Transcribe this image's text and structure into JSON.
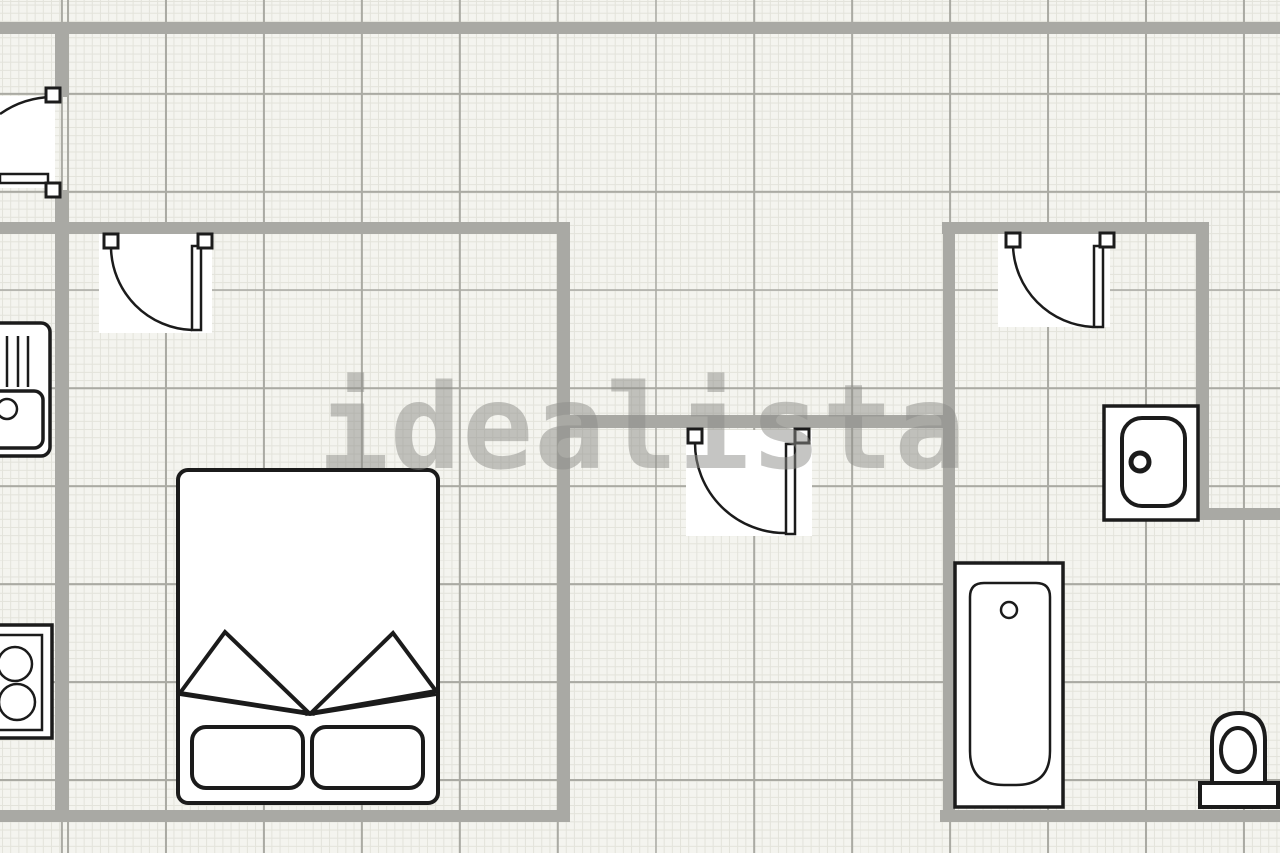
{
  "watermark": {
    "text": "idealista",
    "color": "#8d8d89"
  },
  "colors": {
    "background": "#f4f4ef",
    "grid_fine": "#e3e3db",
    "grid_coarse": "#aaaaa3",
    "wall": "#a9a9a4",
    "outline": "#1b1b1b",
    "fixture_fill": "#ffffff",
    "watermark": "#8d8d89"
  },
  "plan": {
    "type": "floor-plan",
    "fixtures": [
      {
        "name": "entry-door",
        "type": "door-with-swing-arc"
      },
      {
        "name": "bedroom-door",
        "type": "door-with-swing-arc"
      },
      {
        "name": "hallway-door",
        "type": "door-with-swing-arc"
      },
      {
        "name": "bathroom-door",
        "type": "door-with-swing-arc"
      },
      {
        "name": "kitchen-sink-with-drainer",
        "type": "sink"
      },
      {
        "name": "cooktop-two-burners",
        "type": "stove"
      },
      {
        "name": "double-bed-with-pillows",
        "type": "bed"
      },
      {
        "name": "washbasin",
        "type": "sink"
      },
      {
        "name": "bathtub",
        "type": "bathtub"
      },
      {
        "name": "toilet",
        "type": "toilet"
      }
    ]
  }
}
